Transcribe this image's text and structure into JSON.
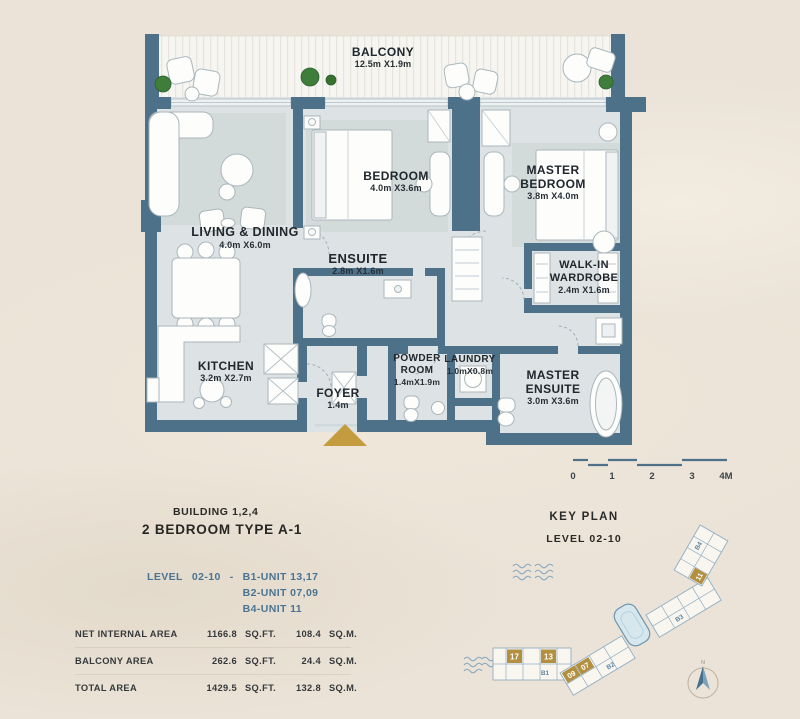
{
  "plan": {
    "balcony": {
      "name": "BALCONY",
      "dims": "12.5m X1.9m"
    },
    "living": {
      "name": "LIVING & DINING",
      "dims": "4.0m X6.0m"
    },
    "bedroom": {
      "name": "BEDROOM",
      "dims": "4.0m X3.6m"
    },
    "master_bedroom": {
      "name1": "MASTER",
      "name2": "BEDROOM",
      "dims": "3.8m X4.0m"
    },
    "ensuite": {
      "name": "ENSUITE",
      "dims": "2.8m X1.6m"
    },
    "wardrobe": {
      "name1": "WALK-IN",
      "name2": "WARDROBE",
      "dims": "2.4m X1.6m"
    },
    "kitchen": {
      "name": "KITCHEN",
      "dims": "3.2m X2.7m"
    },
    "foyer": {
      "name": "FOYER",
      "dims": "1.4m"
    },
    "powder": {
      "name1": "POWDER",
      "name2": "ROOM",
      "dims": "1.4mX1.9m"
    },
    "laundry": {
      "name": "LAUNDRY",
      "dims": "1.0mX0.8m"
    },
    "master_ensuite": {
      "name1": "MASTER",
      "name2": "ENSUITE",
      "dims": "3.0m X3.6m"
    }
  },
  "scale_bar": {
    "ticks": [
      "0",
      "1",
      "2",
      "3",
      "4M"
    ]
  },
  "info": {
    "building": "BUILDING 1,2,4",
    "unit_type": "2 BEDROOM TYPE A-1",
    "level_label": "LEVEL",
    "level_value": "02-10",
    "separator": "-",
    "units": [
      "B1-UNIT 13,17",
      "B2-UNIT 07,09",
      "B4-UNIT 11"
    ]
  },
  "area_table": {
    "sqft_unit": "SQ.FT.",
    "sqm_unit": "SQ.M.",
    "rows": [
      {
        "label": "NET INTERNAL AREA",
        "sqft": "1166.8",
        "sqm": "108.4"
      },
      {
        "label": "BALCONY AREA",
        "sqft": "262.6",
        "sqm": "24.4"
      },
      {
        "label": "TOTAL AREA",
        "sqft": "1429.5",
        "sqm": "132.8"
      }
    ]
  },
  "key_plan": {
    "title": "KEY PLAN",
    "subtitle": "LEVEL 02-10",
    "buildings": [
      "B1",
      "B2",
      "B3",
      "B4"
    ],
    "highlighted_units": [
      "17",
      "13",
      "09",
      "07",
      "11"
    ],
    "compass_label": "N"
  },
  "colors": {
    "wall": "#4d7189",
    "floor": "#dde3e4",
    "accent_gold": "#c49c3f",
    "key_plan_blue": "#8fb0c6",
    "text_blue": "#4b7492",
    "background": "#ebe3d7"
  }
}
